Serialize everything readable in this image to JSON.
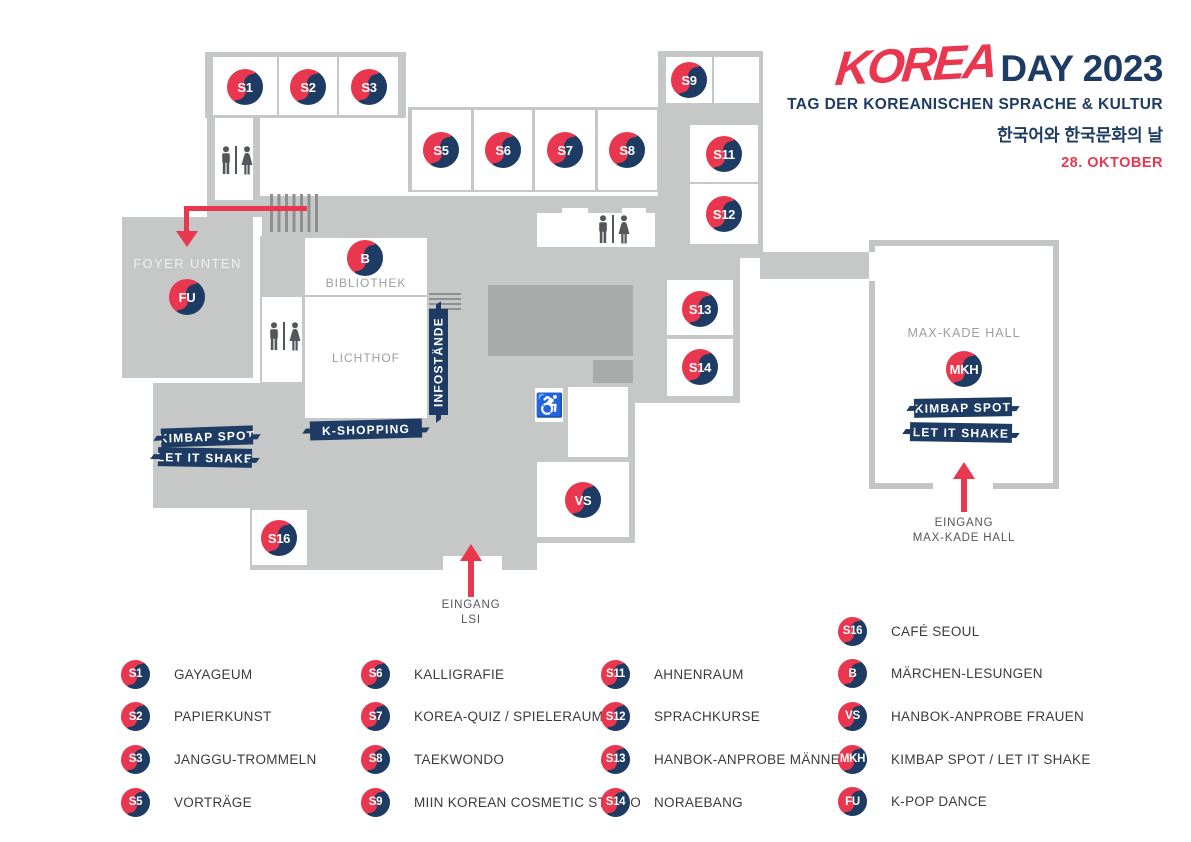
{
  "header": {
    "logo_korea": "KOREA",
    "logo_day": "DAY 2023",
    "subtitle": "TAG DER KOREANISCHEN SPRACHE & KULTUR",
    "subtitle_korean": "한국어와 한국문화의 날",
    "date": "28. OKTOBER"
  },
  "colors": {
    "red": "#e8374e",
    "navy": "#1e3c63",
    "building_gray": "#c6c7c7",
    "block_gray": "#a9abaa",
    "icon_gray": "#54565a",
    "room_label_gray": "#9b9ea1"
  },
  "map": {
    "badges": {
      "s1": "S1",
      "s2": "S2",
      "s3": "S3",
      "s5": "S5",
      "s6": "S6",
      "s7": "S7",
      "s8": "S8",
      "s9": "S9",
      "s11": "S11",
      "s12": "S12",
      "s13": "S13",
      "s14": "S14",
      "s16": "S16",
      "b": "B",
      "vs": "VS",
      "fu": "FU",
      "mkh": "MKH"
    },
    "texts": {
      "foyer": "FOYER UNTEN",
      "bibliothek": "BIBLIOTHEK",
      "lichthof": "LICHTHOF",
      "max_kade": "MAX-KADE HALL",
      "infostaende": "INFOSTÄNDE",
      "k_shopping": "K-SHOPPING",
      "kimbap": "KIMBAP SPOT",
      "let_it_shake": "LET IT SHAKE",
      "eingang": "EINGANG",
      "lsi": "LSI",
      "mkh_entry_line1": "EINGANG",
      "mkh_entry_line2": "MAX-KADE HALL"
    }
  },
  "legend": {
    "columns": [
      {
        "items": [
          {
            "code": "S1",
            "label": "GAYAGEUM"
          },
          {
            "code": "S2",
            "label": "PAPIERKUNST"
          },
          {
            "code": "S3",
            "label": "JANGGU-TROMMELN"
          },
          {
            "code": "S5",
            "label": "VORTRÄGE"
          }
        ]
      },
      {
        "items": [
          {
            "code": "S6",
            "label": "KALLIGRAFIE"
          },
          {
            "code": "S7",
            "label": "KOREA-QUIZ / SPIELERAUM"
          },
          {
            "code": "S8",
            "label": "TAEKWONDO"
          },
          {
            "code": "S9",
            "label": "MIIN KOREAN COSMETIC STUDIO"
          }
        ]
      },
      {
        "items": [
          {
            "code": "S11",
            "label": "AHNENRAUM"
          },
          {
            "code": "S12",
            "label": "SPRACHKURSE"
          },
          {
            "code": "S13",
            "label": "HANBOK-ANPROBE MÄNNER"
          },
          {
            "code": "S14",
            "label": "NORAEBANG"
          }
        ]
      },
      {
        "items": [
          {
            "code": "S16",
            "label": "CAFÉ SEOUL"
          },
          {
            "code": "B",
            "label": "MÄRCHEN-LESUNGEN"
          },
          {
            "code": "VS",
            "label": "HANBOK-ANPROBE FRAUEN"
          },
          {
            "code": "MKH",
            "label": "KIMBAP SPOT / LET IT SHAKE"
          },
          {
            "code": "FU",
            "label": "K-POP DANCE"
          }
        ]
      }
    ]
  }
}
